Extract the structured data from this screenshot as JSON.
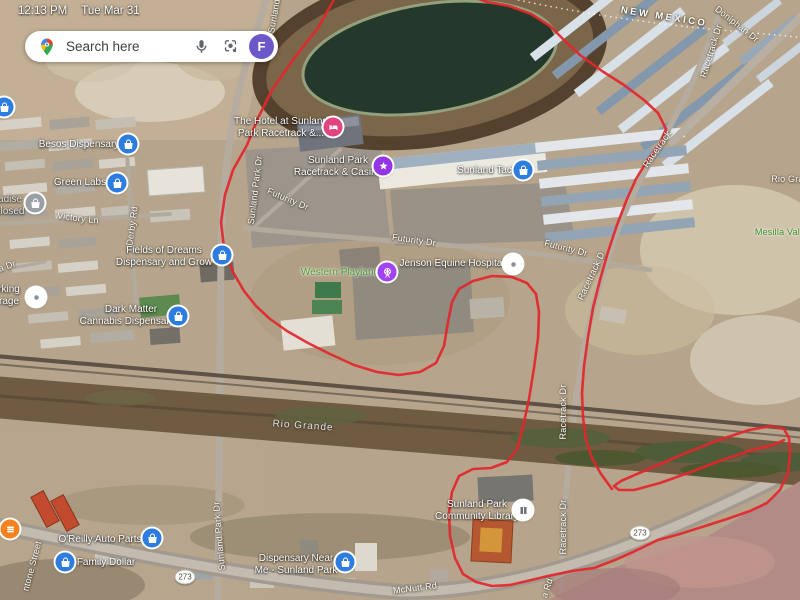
{
  "status_bar": {
    "time": "12:13 PM",
    "date": "Tue Mar 31"
  },
  "search_bar": {
    "placeholder": "Search here",
    "avatar_letter": "F"
  },
  "map": {
    "state_label": "NEW MEXICO",
    "roads": {
      "new_mexico": "NEW MEXICO",
      "doniphan": "Doniphan Dr",
      "racetrack_tr": "Racetrack Dr",
      "racetrack_right": "Racetrack",
      "racetrack_mid": "Racetrack D",
      "racetrack_mid2": "Racetrack Dr",
      "racetrack_south": "Racetrack Dr",
      "sunland_top": "Sunland",
      "sunland_mid": "Sunland Park Dr",
      "sunland_south": "Sunland Park Dr",
      "futurity_1": "Futurity Dr",
      "futurity_2": "Futurity Dr",
      "futurity_3": "Futurity Dr",
      "victory": "Victory Ln",
      "derby": "Derby Rd",
      "a_dr": "a Dr",
      "ntone": "ntone Street",
      "mcnutt": "McNutt Rd",
      "a_rd": "a Rd",
      "rio_river": "Rio Grande",
      "rio_right": "Rio Gran",
      "mesilla": "Mesilla Vale",
      "shield": "273"
    },
    "pois": {
      "besos": {
        "l1": "Besos Dispensary"
      },
      "green_labs": {
        "l1": "Green Labs"
      },
      "fields": {
        "l1": "Fields of Dreams",
        "l2": "Dispensary and Grow"
      },
      "dark_matter": {
        "l1": "Dark Matter",
        "l2": "Cannabis Dispensary..."
      },
      "hotel": {
        "l1": "The Hotel at Sunland",
        "l2": "Park Racetrack &..."
      },
      "casino": {
        "l1": "Sunland Park",
        "l2": "Racetrack & Casino"
      },
      "tack": {
        "l1": "Sunland Tack"
      },
      "playland": {
        "l1": "Western Playland"
      },
      "jenson": {
        "l1": "Jenson Equine Hospital"
      },
      "library": {
        "l1": "Sunland Park",
        "l2": "Community Library"
      },
      "oreilly": {
        "l1": "O'Reilly Auto Parts"
      },
      "family_dollar": {
        "l1": "Family Dollar"
      },
      "dispensary_near": {
        "l1": "Dispensary Near",
        "l2": "Me - Sunland Park"
      },
      "closed_partial": {
        "l1": "adise",
        "l2": "closed"
      },
      "parking_partial": {
        "l1": "rking",
        "l2": "rage"
      }
    },
    "route": {
      "color": "#e3262c",
      "main": [
        [
          337,
          -6
        ],
        [
          318,
          28
        ],
        [
          295,
          57
        ],
        [
          272,
          90
        ],
        [
          258,
          118
        ],
        [
          247,
          145
        ],
        [
          233,
          170
        ],
        [
          225,
          195
        ],
        [
          221,
          222
        ],
        [
          224,
          248
        ],
        [
          233,
          272
        ],
        [
          244,
          291
        ],
        [
          256,
          306
        ],
        [
          270,
          319
        ],
        [
          287,
          331
        ],
        [
          308,
          343
        ],
        [
          330,
          354
        ],
        [
          354,
          365
        ],
        [
          377,
          372
        ],
        [
          399,
          375
        ],
        [
          420,
          372
        ],
        [
          436,
          363
        ],
        [
          444,
          346
        ],
        [
          448,
          322
        ],
        [
          452,
          302
        ],
        [
          459,
          289
        ],
        [
          473,
          281
        ],
        [
          492,
          276
        ],
        [
          512,
          277
        ],
        [
          527,
          283
        ],
        [
          536,
          294
        ],
        [
          539,
          312
        ],
        [
          538,
          338
        ],
        [
          534,
          368
        ],
        [
          529,
          399
        ],
        [
          523,
          427
        ],
        [
          517,
          449
        ],
        [
          507,
          462
        ],
        [
          491,
          468
        ],
        [
          473,
          469
        ],
        [
          459,
          476
        ],
        [
          452,
          492
        ],
        [
          449,
          513
        ],
        [
          450,
          536
        ],
        [
          455,
          558
        ],
        [
          463,
          574
        ],
        [
          476,
          582
        ],
        [
          492,
          586
        ],
        [
          510,
          585
        ],
        [
          527,
          581
        ],
        [
          548,
          576
        ],
        [
          572,
          571
        ],
        [
          594,
          568
        ],
        [
          615,
          560
        ],
        [
          633,
          552
        ],
        [
          658,
          540
        ],
        [
          680,
          534
        ],
        [
          702,
          527
        ],
        [
          727,
          519
        ],
        [
          750,
          511
        ],
        [
          767,
          503
        ],
        [
          780,
          490
        ],
        [
          788,
          473
        ],
        [
          790,
          454
        ],
        [
          789,
          438
        ],
        [
          784,
          429
        ],
        [
          771,
          426
        ],
        [
          749,
          430
        ],
        [
          719,
          440
        ],
        [
          688,
          452
        ],
        [
          658,
          465
        ],
        [
          637,
          474
        ],
        [
          621,
          481
        ],
        [
          614,
          486
        ],
        [
          619,
          490
        ],
        [
          634,
          490
        ],
        [
          660,
          483
        ],
        [
          691,
          472
        ],
        [
          722,
          460
        ],
        [
          752,
          450
        ],
        [
          773,
          445
        ],
        [
          784,
          440
        ]
      ],
      "north": [
        [
          612,
          489
        ],
        [
          601,
          474
        ],
        [
          592,
          458
        ],
        [
          586,
          440
        ],
        [
          583,
          417
        ],
        [
          582,
          393
        ],
        [
          584,
          366
        ],
        [
          588,
          337
        ],
        [
          593,
          308
        ],
        [
          600,
          280
        ],
        [
          608,
          252
        ],
        [
          617,
          225
        ],
        [
          627,
          199
        ],
        [
          636,
          179
        ],
        [
          647,
          161
        ],
        [
          660,
          144
        ],
        [
          666,
          129
        ],
        [
          658,
          113
        ],
        [
          644,
          100
        ],
        [
          624,
          85
        ],
        [
          602,
          71
        ],
        [
          580,
          55
        ],
        [
          564,
          40
        ],
        [
          550,
          26
        ],
        [
          531,
          14
        ],
        [
          509,
          6
        ],
        [
          487,
          2
        ],
        [
          468,
          -5
        ]
      ]
    }
  }
}
